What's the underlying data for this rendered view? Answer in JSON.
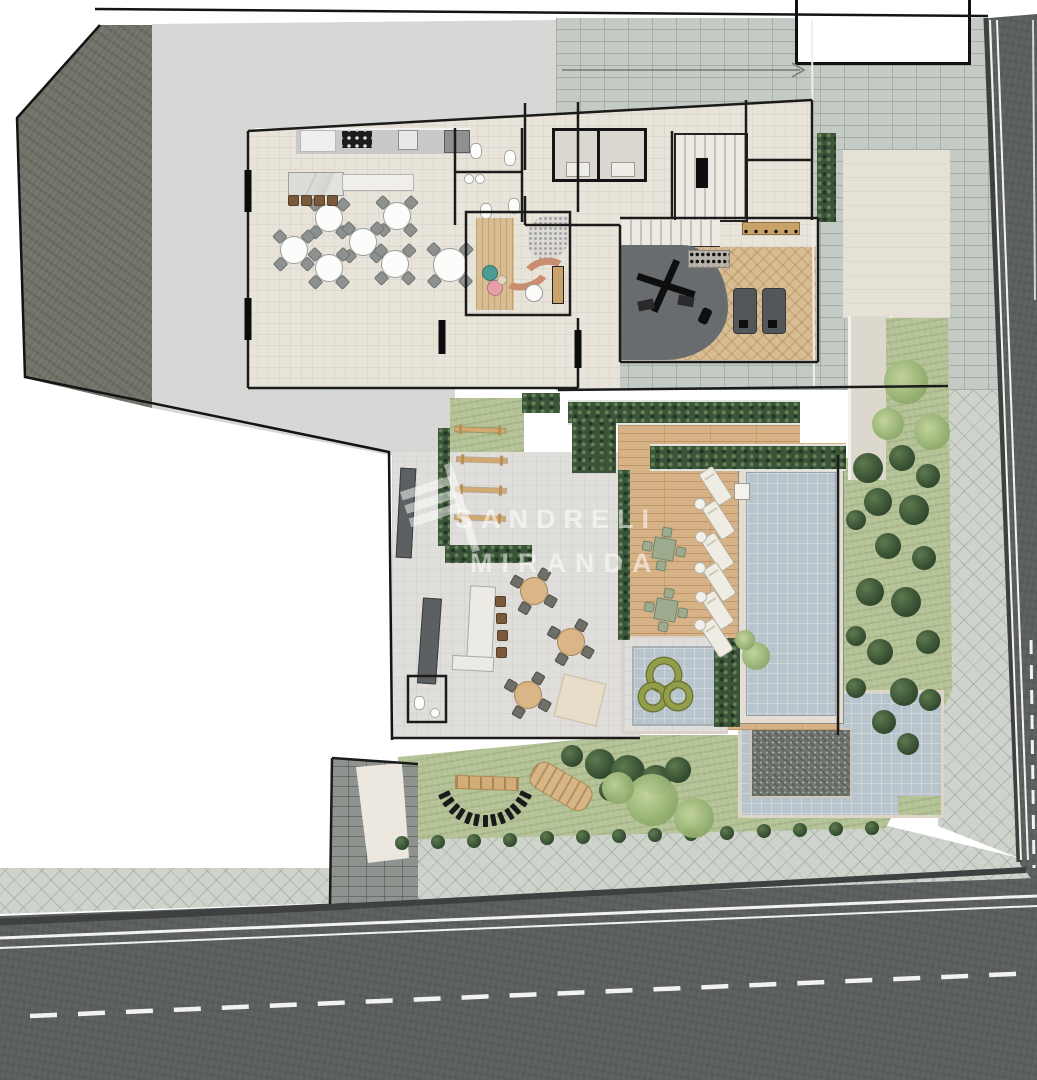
{
  "watermark": {
    "line1": "SANDRELI",
    "line2": "MIRANDA",
    "logo": "striped-building-logo"
  },
  "palette": {
    "concrete": "#6e7267",
    "pavers": "#c4cac4",
    "sidewalk": "#ced3cc",
    "asphalt": "#5b5f5e",
    "lawn": "#b4c296",
    "hedge": "#3a5339",
    "deck_wood": "#d7b286",
    "gym_wood": "#d8bd92",
    "pool_water": "#b8c4cc",
    "dark_water": "#6f746e",
    "floor": "#e9e4da",
    "gym_mat": "#686c6e",
    "sofa_terracotta": "#c98d72",
    "pouf_teal": "#4a9a96",
    "pouf_pink": "#e8a0a8",
    "ring_green": "#939e48"
  },
  "scene": {
    "regions": [
      "street-south",
      "street-east",
      "sidewalk",
      "paver-court",
      "concrete-lot",
      "vacant-lot",
      "dining-hall",
      "kitchen",
      "bar-counter",
      "restrooms",
      "elevators",
      "fire-stair",
      "gym",
      "kids-room",
      "pool-deck",
      "swimming-pool",
      "kids-pool",
      "water-feature",
      "bbq-terrace",
      "pet-play-lawn",
      "garden",
      "driveway-ramp"
    ],
    "dining_tables": [
      {
        "x": 328,
        "y": 217
      },
      {
        "x": 396,
        "y": 215
      },
      {
        "x": 293,
        "y": 249
      },
      {
        "x": 362,
        "y": 241
      },
      {
        "x": 328,
        "y": 267
      },
      {
        "x": 394,
        "y": 263
      }
    ],
    "head_table": {
      "x": 449,
      "y": 264
    },
    "wood_tables": [
      {
        "x": 533,
        "y": 590
      },
      {
        "x": 570,
        "y": 641
      },
      {
        "x": 527,
        "y": 694
      }
    ],
    "deck_tables": [
      {
        "x": 663,
        "y": 548
      },
      {
        "x": 665,
        "y": 609
      }
    ],
    "loungers": [
      {
        "x": 714,
        "y": 485
      },
      {
        "x": 717,
        "y": 519
      },
      {
        "x": 716,
        "y": 551
      },
      {
        "x": 718,
        "y": 581
      },
      {
        "x": 716,
        "y": 609
      },
      {
        "x": 715,
        "y": 637
      }
    ],
    "side_tables": [
      {
        "x": 699,
        "y": 503
      },
      {
        "x": 700,
        "y": 536
      },
      {
        "x": 699,
        "y": 567
      },
      {
        "x": 700,
        "y": 596
      },
      {
        "x": 699,
        "y": 624
      }
    ],
    "float_rings": [
      {
        "x": 659,
        "y": 670,
        "r": 12
      },
      {
        "x": 648,
        "y": 692,
        "r": 9
      },
      {
        "x": 673,
        "y": 691,
        "r": 9
      }
    ],
    "step_posts": {
      "cx": 485,
      "cy": 776,
      "r": 45,
      "a0": 25,
      "a1": 155,
      "n": 13
    },
    "hurdles": [
      {
        "x": 480,
        "y": 430
      },
      {
        "x": 482,
        "y": 460
      },
      {
        "x": 481,
        "y": 490
      },
      {
        "x": 480,
        "y": 518
      }
    ],
    "bottom_shrubs": {
      "x0": 402,
      "y0": 843,
      "x1": 872,
      "y1": 828,
      "n": 14
    },
    "right_blobs": [
      [
        868,
        468,
        15
      ],
      [
        902,
        458,
        13
      ],
      [
        928,
        476,
        12
      ],
      [
        878,
        502,
        14
      ],
      [
        914,
        510,
        15
      ],
      [
        888,
        546,
        13
      ],
      [
        924,
        558,
        12
      ],
      [
        870,
        592,
        14
      ],
      [
        906,
        602,
        15
      ],
      [
        928,
        642,
        12
      ],
      [
        880,
        652,
        13
      ],
      [
        904,
        692,
        14
      ],
      [
        884,
        722,
        12
      ],
      [
        908,
        744,
        11
      ],
      [
        856,
        520,
        10
      ],
      [
        856,
        636,
        10
      ],
      [
        856,
        688,
        10
      ],
      [
        930,
        700,
        11
      ]
    ],
    "bush_cluster": [
      [
        600,
        764,
        15
      ],
      [
        628,
        772,
        17
      ],
      [
        656,
        780,
        15
      ],
      [
        678,
        770,
        13
      ],
      [
        610,
        790,
        11
      ],
      [
        572,
        756,
        11
      ]
    ],
    "light_trees": [
      [
        652,
        800,
        26
      ],
      [
        694,
        818,
        20
      ],
      [
        618,
        788,
        16
      ],
      [
        906,
        382,
        22
      ],
      [
        932,
        432,
        18
      ],
      [
        888,
        424,
        16
      ],
      [
        756,
        656,
        14
      ],
      [
        745,
        640,
        10
      ]
    ],
    "bar_stools": [
      {
        "x": 292,
        "y": 199
      },
      {
        "x": 305,
        "y": 199
      },
      {
        "x": 318,
        "y": 199
      },
      {
        "x": 331,
        "y": 199
      },
      {
        "x": 499,
        "y": 600
      },
      {
        "x": 500,
        "y": 617
      },
      {
        "x": 501,
        "y": 634
      },
      {
        "x": 500,
        "y": 651
      }
    ],
    "poufs": [
      {
        "x": 489,
        "y": 272,
        "r": 7,
        "c": "#4a9a96"
      },
      {
        "x": 494,
        "y": 287,
        "r": 7,
        "c": "#e8a0a8"
      },
      {
        "x": 501,
        "y": 279,
        "r": 4,
        "c": "#e3d6c2"
      }
    ]
  }
}
